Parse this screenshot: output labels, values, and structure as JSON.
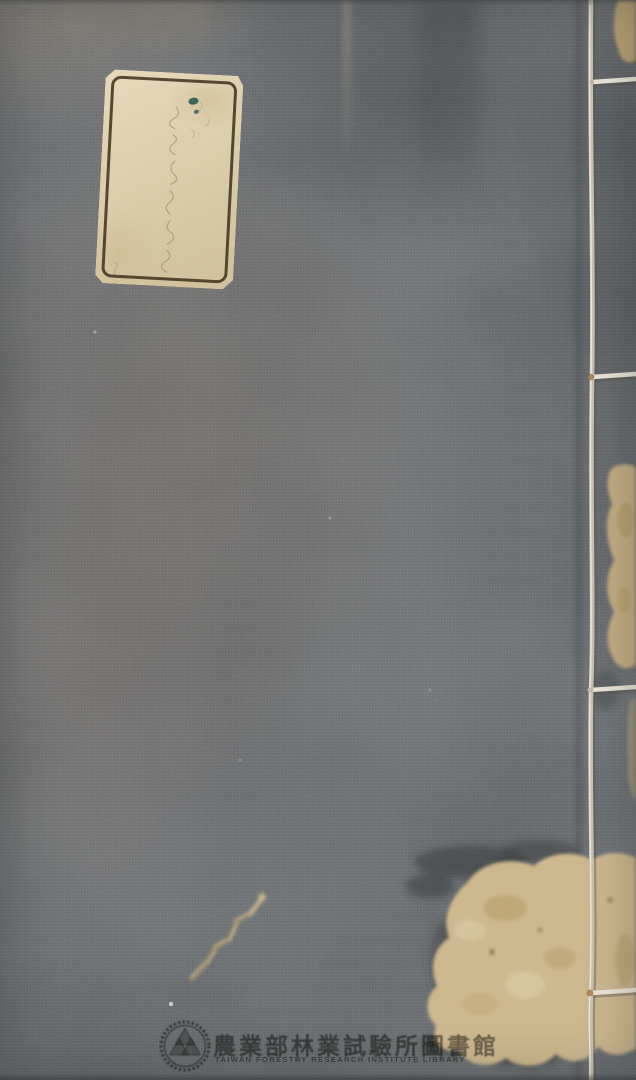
{
  "stamp": {
    "chinese": "農業部林業試驗所圖書館",
    "english": "TAIWAN FORESTRY RESEARCH INSTITUTE LIBRARY",
    "logo": "gear-ring-trefoil-seal-icon"
  },
  "label": {
    "handwriting": "faint handwritten characters (illegible)"
  },
  "binding": {
    "style": "four-hole side-sewn thread binding",
    "holes": 4
  },
  "colors": {
    "cloth_base": "#72767a",
    "cloth_warm": "#7d756e",
    "cloth_dark": "#555c60",
    "label_paper": "#dbcda9",
    "label_border": "#43341f",
    "ink_spot": "#2c5a52",
    "worn_paper": "#cdb88f",
    "stain": "#8a6f45",
    "thread": "#ece6d8",
    "stamp_ink": "#3a3732"
  }
}
